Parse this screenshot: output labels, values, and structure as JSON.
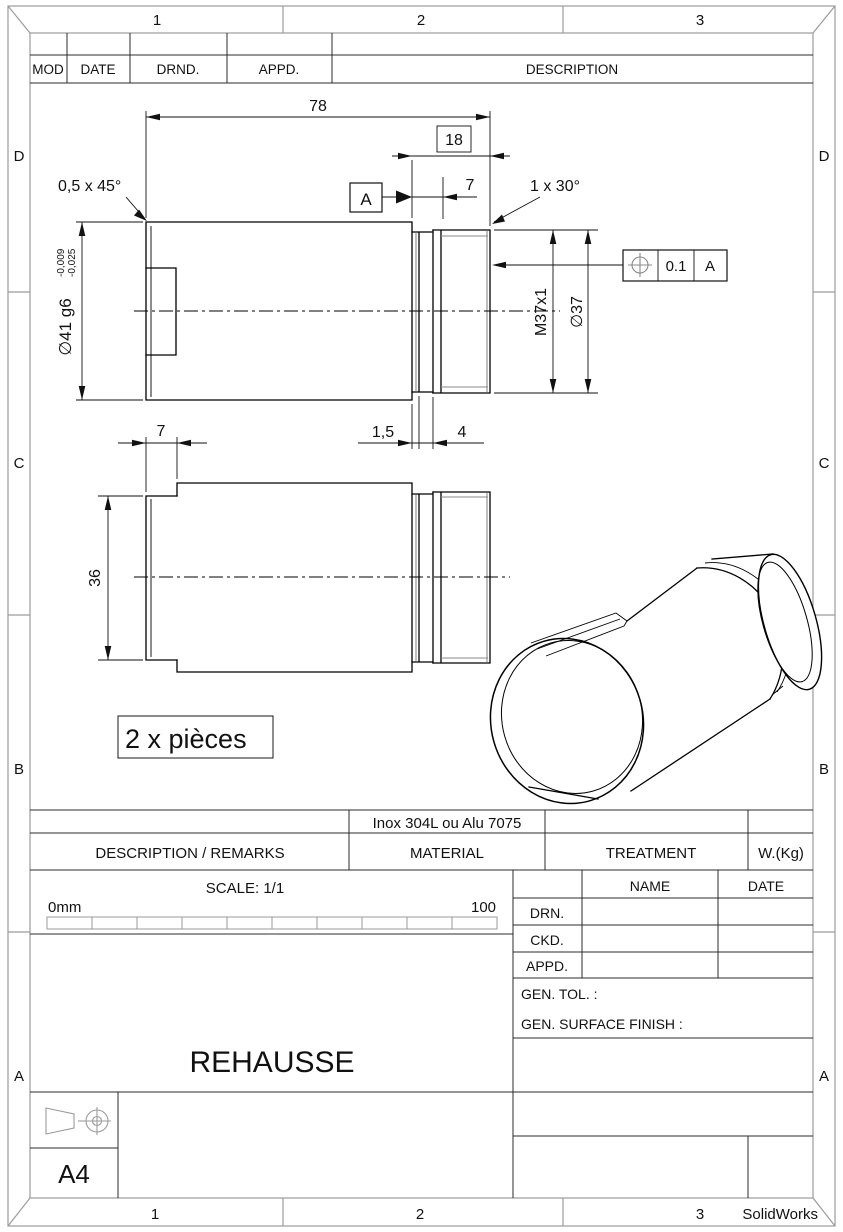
{
  "zones": {
    "columns": [
      "1",
      "2",
      "3"
    ],
    "rows": [
      "D",
      "C",
      "B",
      "A"
    ]
  },
  "revision_table": {
    "headers": [
      "MOD",
      "DATE",
      "DRND.",
      "APPD.",
      "DESCRIPTION"
    ]
  },
  "dimensions": {
    "overall_length": "78",
    "thread_zone_length": "18",
    "thread_lead": "7",
    "chamfer_left": "0,5 x 45°",
    "chamfer_right": "1 x 30°",
    "shaft_dia": "∅41 g6",
    "shaft_tol_upper": "-0,009",
    "shaft_tol_lower": "-0,025",
    "thread_spec": "M37x1",
    "thread_dia": "∅37",
    "groove_width": "1,5",
    "groove_relief": "4",
    "step_width": "7",
    "flat_width": "36",
    "datum_label": "A",
    "geo_tol": {
      "value": "0.1",
      "datum": "A"
    }
  },
  "note": "2 x pièces",
  "title_block": {
    "material_value": "Inox 304L ou Alu 7075",
    "headers": {
      "description": "DESCRIPTION   /   REMARKS",
      "material": "MATERIAL",
      "treatment": "TREATMENT",
      "weight": "W.(Kg)"
    },
    "scale_label": "SCALE: 1/1",
    "scale_start": "0mm",
    "scale_end": "100",
    "name_col": "NAME",
    "date_col": "DATE",
    "sign_rows": [
      "DRN.",
      "CKD.",
      "APPD."
    ],
    "gen_tol": "GEN. TOL. :",
    "gen_surface": "GEN. SURFACE FINISH   :",
    "title": "REHAUSSE",
    "sheet_size": "A4",
    "app": "SolidWorks"
  }
}
